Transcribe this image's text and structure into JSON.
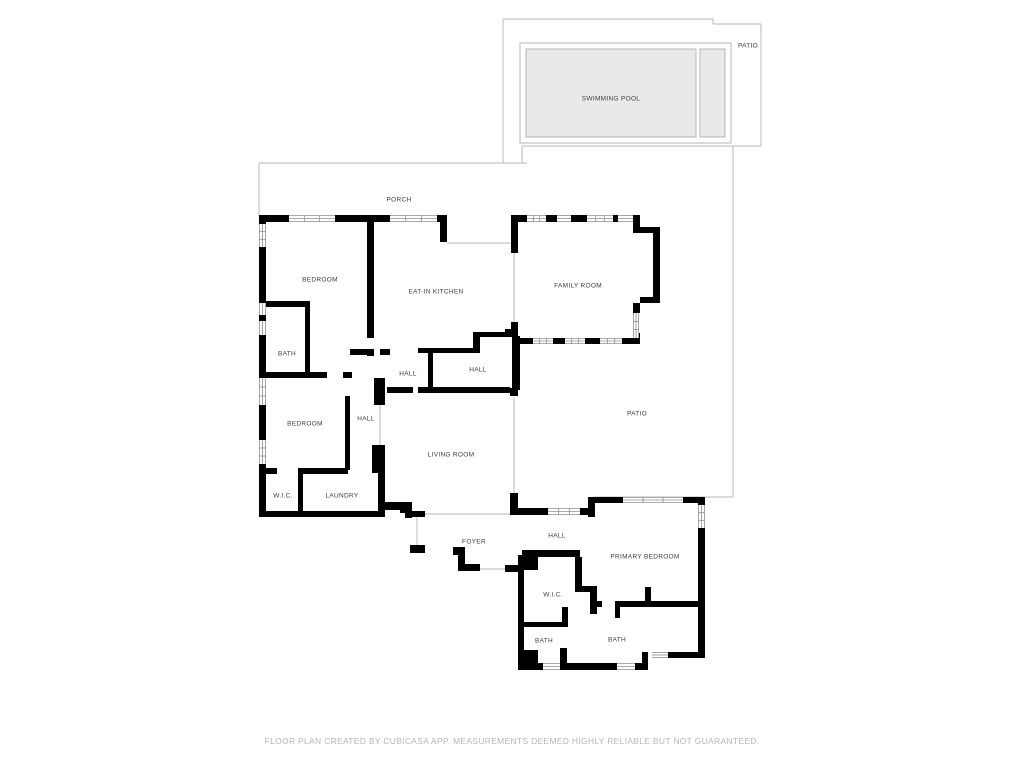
{
  "footer": {
    "text": "FLOOR PLAN CREATED BY CUBICASA APP. MEASUREMENTS DEEMED HIGHLY RELIABLE BUT NOT GUARANTEED."
  },
  "colors": {
    "background": "#ffffff",
    "wall": "#000000",
    "outdoor_outline": "#c5c5c5",
    "window_line": "#8f8f8f",
    "pool_fill": "#e9e9e9",
    "pool_stroke": "#b5b5b5",
    "label_text": "#3c3c3c",
    "footer_text": "#b6b6b6"
  },
  "rooms": [
    {
      "name": "patio-upper",
      "label": "PATIO",
      "x": 748,
      "y": 46
    },
    {
      "name": "swimming-pool",
      "label": "SWIMMING POOL",
      "x": 611,
      "y": 99
    },
    {
      "name": "porch",
      "label": "PORCH",
      "x": 399,
      "y": 200
    },
    {
      "name": "bedroom-1",
      "label": "BEDROOM",
      "x": 320,
      "y": 280
    },
    {
      "name": "eat-in-kitchen",
      "label": "EAT-IN KITCHEN",
      "x": 436,
      "y": 292
    },
    {
      "name": "family-room",
      "label": "FAMILY ROOM",
      "x": 578,
      "y": 286
    },
    {
      "name": "bath-1",
      "label": "BATH",
      "x": 287,
      "y": 354
    },
    {
      "name": "hall-1",
      "label": "HALL",
      "x": 408,
      "y": 374
    },
    {
      "name": "hall-2",
      "label": "HALL",
      "x": 478,
      "y": 370
    },
    {
      "name": "bedroom-2",
      "label": "BEDROOM",
      "x": 305,
      "y": 424
    },
    {
      "name": "hall-3",
      "label": "HALL",
      "x": 366,
      "y": 419
    },
    {
      "name": "patio-main",
      "label": "PATIO",
      "x": 637,
      "y": 414
    },
    {
      "name": "living-room",
      "label": "LIVING ROOM",
      "x": 451,
      "y": 455
    },
    {
      "name": "wic-1",
      "label": "W.I.C.",
      "x": 283,
      "y": 496
    },
    {
      "name": "laundry",
      "label": "LAUNDRY",
      "x": 342,
      "y": 496
    },
    {
      "name": "foyer",
      "label": "FOYER",
      "x": 474,
      "y": 542
    },
    {
      "name": "hall-4",
      "label": "HALL",
      "x": 557,
      "y": 536
    },
    {
      "name": "primary-bedroom",
      "label": "PRIMARY BEDROOM",
      "x": 645,
      "y": 557
    },
    {
      "name": "wic-primary",
      "label": "W.I.C.",
      "x": 553,
      "y": 595
    },
    {
      "name": "bath-primary-1",
      "label": "BATH",
      "x": 544,
      "y": 641
    },
    {
      "name": "bath-primary-2",
      "label": "BATH",
      "x": 617,
      "y": 640
    }
  ]
}
